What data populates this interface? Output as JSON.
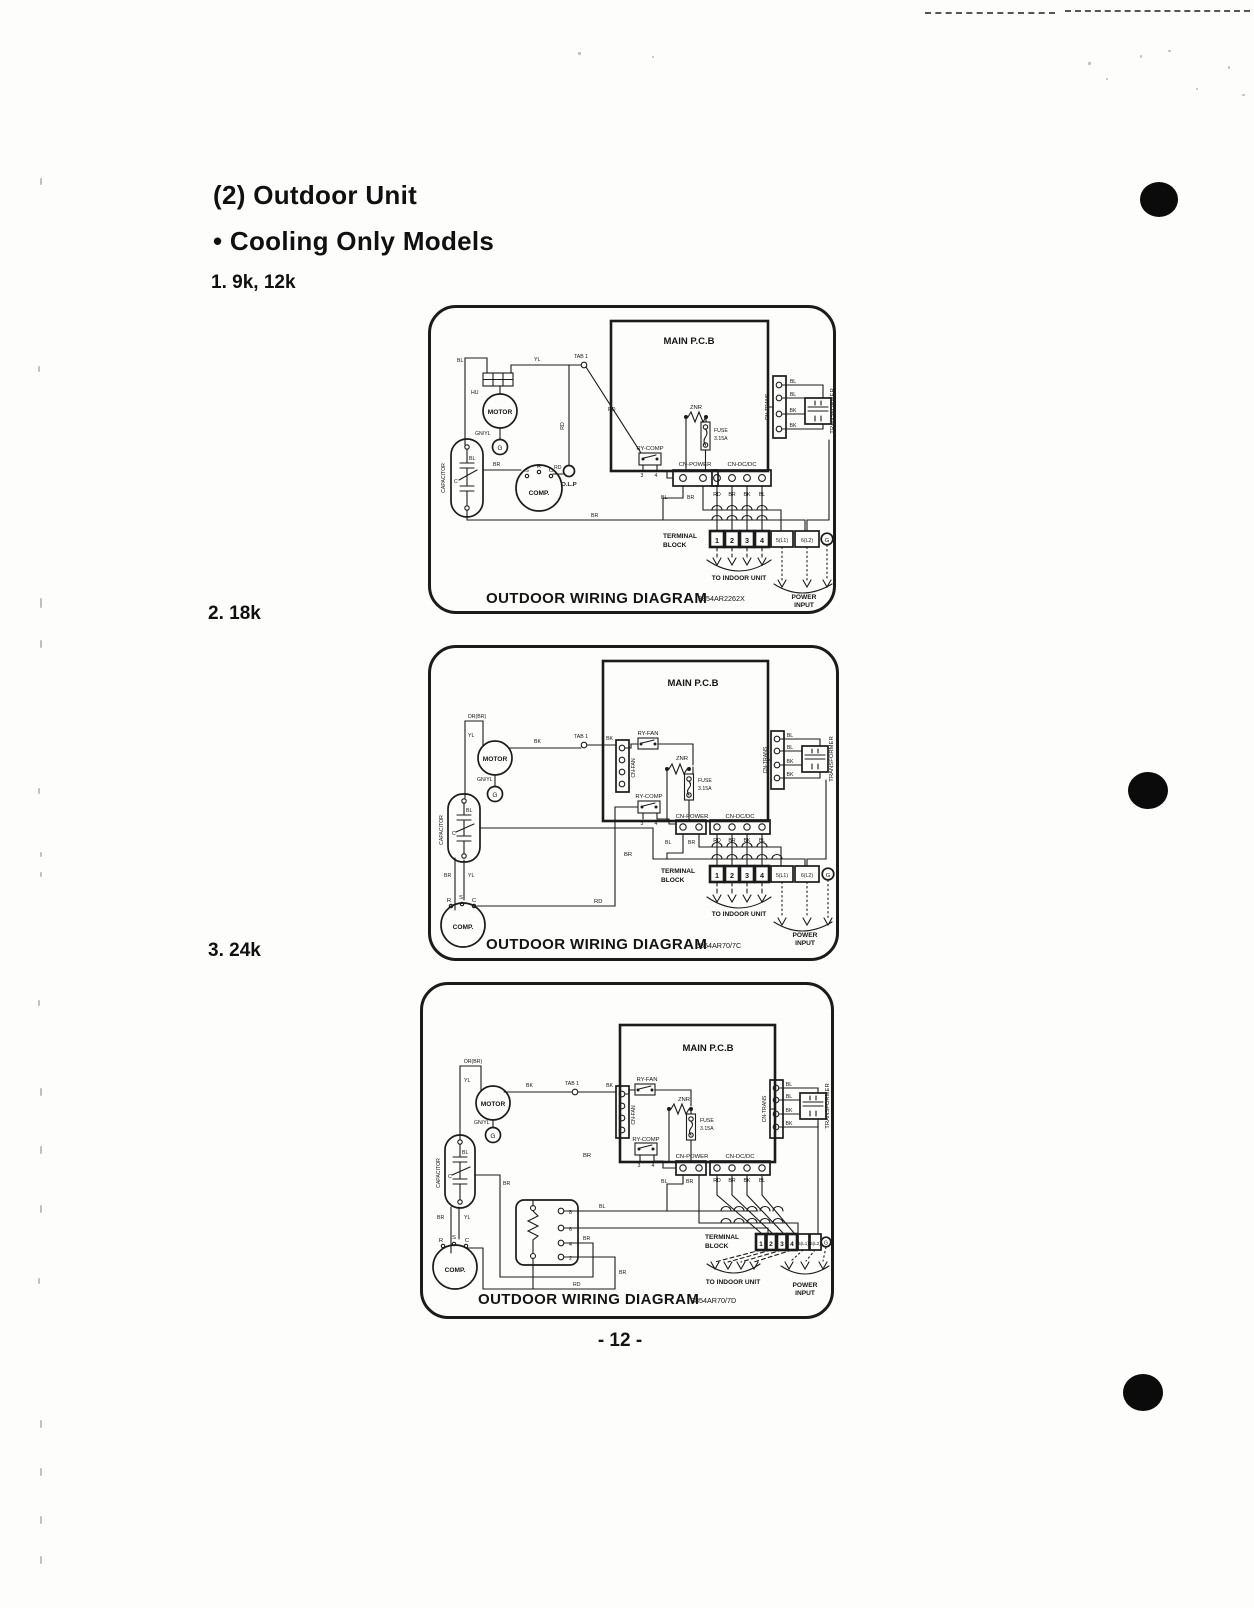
{
  "page": {
    "title": "(2) Outdoor Unit",
    "subtitle": "• Cooling Only Models",
    "footer": "- 12 -"
  },
  "common": {
    "caption": "OUTDOOR WIRING DIAGRAM",
    "main_pcb": "MAIN P.C.B",
    "motor": "MOTOR",
    "capacitor": "CAPACITOR",
    "comp": "COMP.",
    "olp": "O.L.P",
    "hu": "HU",
    "ground": "G",
    "znr": "ZNR",
    "fuse_l1": "FUSE",
    "fuse_l2": "3.15A",
    "ry_comp": "RY-COMP",
    "ry_fan": "RY-FAN",
    "cn_fan": "CN-FAN",
    "cn_power": "CN-POWER",
    "cn_dcdc": "CN-DC/DC",
    "cn_trans": "CN-TRANS",
    "transformer": "TRANSFORMER",
    "terminal_l1": "TERMINAL",
    "terminal_l2": "BLOCK",
    "terminals": [
      "1",
      "2",
      "3",
      "4",
      "5(L1)",
      "6(L2)"
    ],
    "to_indoor": "TO INDOOR UNIT",
    "power_l1": "POWER",
    "power_l2": "INPUT",
    "tab1": "TAB 1",
    "pin3": "3",
    "pin4": "4",
    "s": "S",
    "r": "R",
    "c": "C",
    "bl": "BL",
    "bk": "BK",
    "br": "BR",
    "rd": "RD",
    "yl": "YL",
    "gnyl": "GN/YL",
    "orbr": "OR(BR)"
  },
  "diagram1": {
    "heading": "1. 9k, 12k",
    "part_number": "3854AR2262X"
  },
  "diagram2": {
    "heading": "2. 18k",
    "part_number": "5854AR70/7C"
  },
  "diagram3": {
    "heading": "3. 24k",
    "part_number": "3854AR70/7D",
    "contactor_pins": [
      "8",
      "6",
      "4",
      "2"
    ]
  }
}
